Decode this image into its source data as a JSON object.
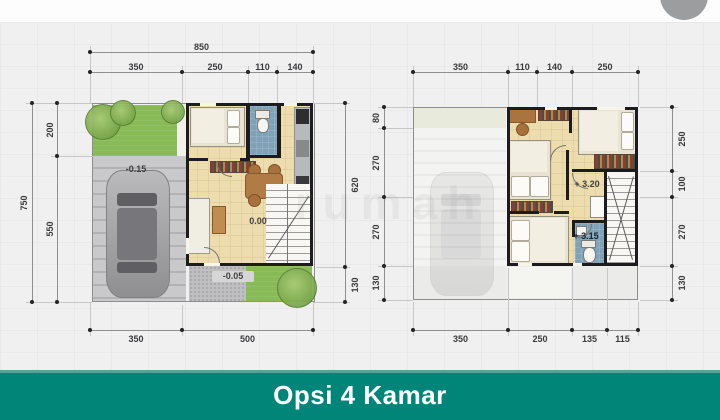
{
  "watermark": {
    "text": "rumah"
  },
  "plans": {
    "left": {
      "top_total": "850",
      "top_segments": [
        "350",
        "250",
        "110",
        "140"
      ],
      "left_outer": "750",
      "left_inner": [
        "200",
        "550"
      ],
      "right_side": [
        "620",
        "130"
      ],
      "bottom": [
        "350",
        "500"
      ],
      "levels": {
        "carport": "-0.15",
        "living": "0.00",
        "porch": "-0.05"
      }
    },
    "right": {
      "top_segments": [
        "350",
        "110",
        "140",
        "250"
      ],
      "left_side": [
        "80",
        "270",
        "270",
        "130"
      ],
      "right_side": [
        "250",
        "100",
        "270",
        "130"
      ],
      "bottom": [
        "350",
        "250",
        "135",
        "115"
      ],
      "levels": {
        "hall": "+ 3.20",
        "bath": "+ 3.15"
      }
    }
  },
  "banner": {
    "title": "Opsi 4 Kamar"
  },
  "colors": {
    "banner": "#008578",
    "banner_edge": "#56A294",
    "background": "#F0F0F1",
    "grass": "#88BA58",
    "floor": "#ECDCAE",
    "bathroom": "#7FA2B8",
    "wall": "#1C1C1E",
    "carport": "#C9C9CB",
    "avatar": "#9B9D9F"
  }
}
